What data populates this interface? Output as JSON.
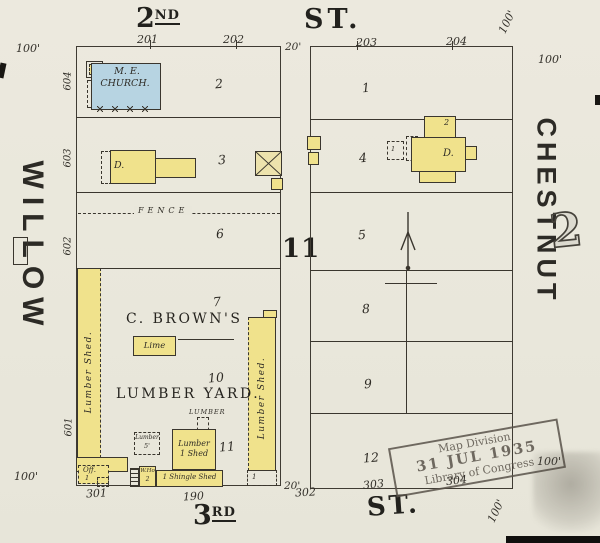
{
  "colors": {
    "paper": "#eae8dd",
    "yellow": "#f0e28c",
    "blue": "#b7d4e2",
    "ink": "#3a362e",
    "stampink": "#59534a"
  },
  "measurements": {
    "hundred": "100'",
    "twenty": "20'"
  },
  "streets": {
    "second_num": "2",
    "second_ord": "ND",
    "second_st": "ST.",
    "third_num": "3",
    "third_ord": "RD",
    "third_st": "ST.",
    "willow": "WILLOW",
    "chestnut": "CHESTNUT"
  },
  "plate_number": "2",
  "block_number": "11",
  "tiny_one": "1",
  "left_block": {
    "top_numbers": [
      "201",
      "202"
    ],
    "bottom_numbers": [
      "301",
      "190",
      "302"
    ],
    "side_numbers": [
      "604",
      "603",
      "602",
      "601"
    ],
    "lot_numbers": [
      "2",
      "3",
      "6",
      "7",
      "10",
      "11"
    ],
    "church_line1": "M. E.",
    "church_line2": "CHURCH.",
    "dwelling": "D.",
    "fence": "FENCE",
    "owner_line1": "C. BROWN'S",
    "owner_line2": "LUMBER YARD.",
    "lime": "Lime",
    "shed_left": "Lumber Shed.",
    "shed_right": "Lumber Shed.",
    "lumber_small": "Lumber",
    "lumber_5_1": "Lumber",
    "lumber_5_2": "5'",
    "shed_sq_1": "Lumber",
    "shed_sq_2": "1 Shed",
    "shingle_shed": "1 Shingle Shed",
    "office_1": "Off.",
    "office_2": "1",
    "who_1": "W.Ho",
    "who_2": "2"
  },
  "right_block": {
    "top_numbers": [
      "203",
      "204"
    ],
    "bottom_numbers": [
      "303",
      "304"
    ],
    "lot_numbers": [
      "1",
      "4",
      "5",
      "8",
      "9",
      "12"
    ],
    "dwelling": "D.",
    "dwelling_story": "2"
  },
  "stamp": {
    "line1": "Map Division",
    "line2": "31 JUL 1935",
    "line3": "Library of Congress"
  }
}
